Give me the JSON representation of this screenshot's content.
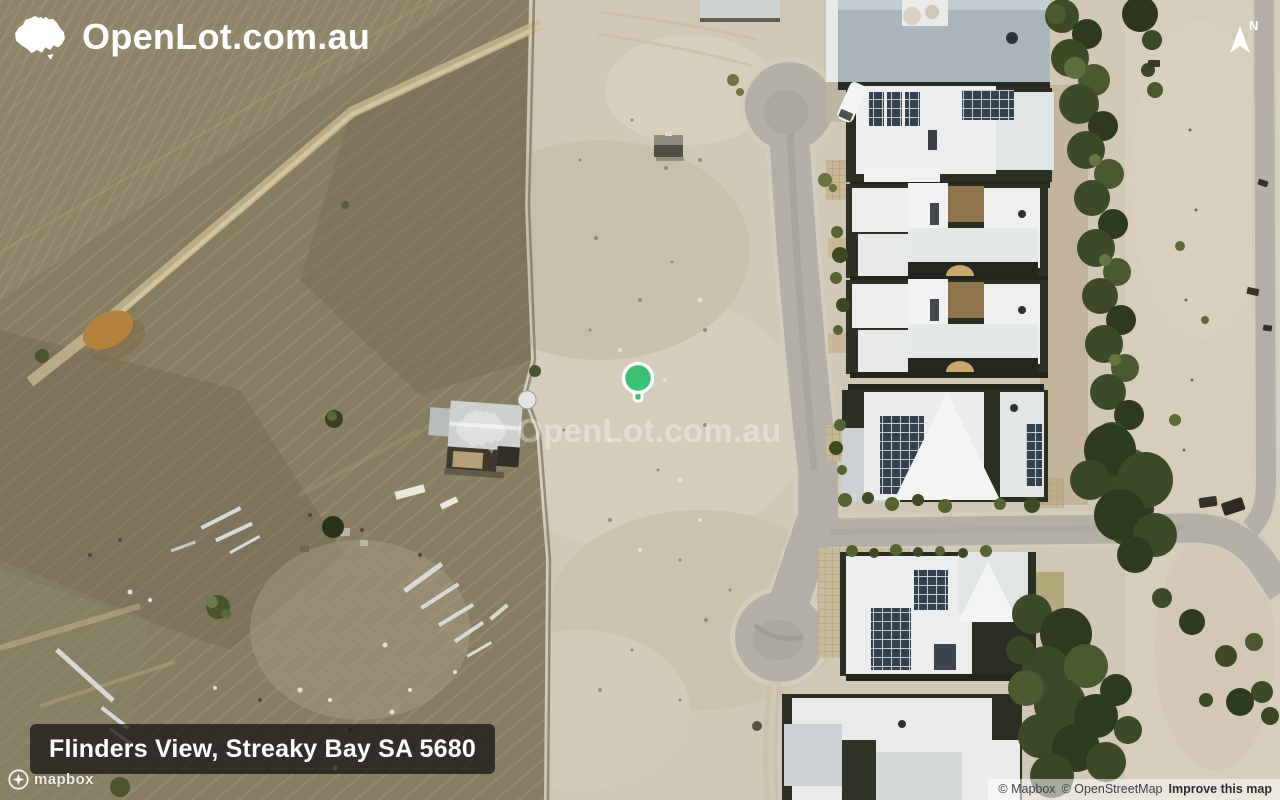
{
  "branding": {
    "logo_text": "OpenLot.com.au",
    "logo_icon": "australia-map-icon"
  },
  "watermark": {
    "text": "OpenLot.com.au",
    "icon": "australia-map-icon"
  },
  "compass": {
    "label": "N"
  },
  "marker": {
    "shape": "circle-pin",
    "position_px": {
      "x": 638,
      "y": 378
    }
  },
  "location_label": {
    "text": "Flinders View, Streaky Bay SA 5680"
  },
  "mapbox_logo": {
    "text": "mapbox"
  },
  "attribution": {
    "mapbox": "© Mapbox",
    "osm": "© OpenStreetMap",
    "improve": "Improve this map"
  },
  "map": {
    "type": "satellite"
  },
  "colors": {
    "marker-green": "#3ac173",
    "label-bg": "rgba(20,20,20,0.75)",
    "label-text": "#ffffff",
    "logo-text": "#ffffff",
    "attribution-bg": "rgba(255,255,255,0.55)",
    "attribution-text": "#3f3f3f",
    "sand": "#d0c7b4",
    "farmland": "#877d61",
    "road": "#b4b0a8",
    "tree": "#3d4a28",
    "roof-white": "#edeff0",
    "roof-gray": "#a9b4bb"
  }
}
